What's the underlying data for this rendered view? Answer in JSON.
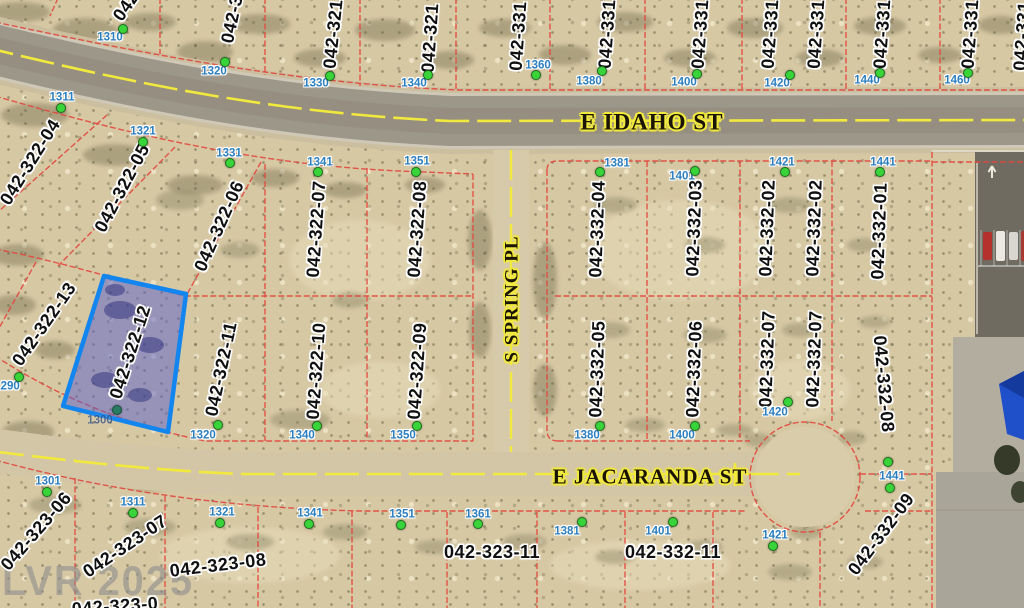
{
  "map": {
    "watermark": "LVR 2025",
    "selected_parcel": {
      "id": "042-322-12"
    },
    "streets": [
      {
        "name": "E IDAHO ST",
        "x": 652,
        "y": 122,
        "rot": 0,
        "size": 23
      },
      {
        "name": "S SPRING PL",
        "x": 512,
        "y": 299,
        "rot": -90,
        "size": 19
      },
      {
        "name": "E JACARANDA ST",
        "x": 650,
        "y": 477,
        "rot": 0,
        "size": 21
      }
    ],
    "parcel_labels": [
      {
        "id": "042",
        "x": 126,
        "y": 6,
        "rot": -55
      },
      {
        "id": "042-32",
        "x": 233,
        "y": 14,
        "rot": -78
      },
      {
        "id": "042-321",
        "x": 333,
        "y": 34,
        "rot": -84
      },
      {
        "id": "042-321",
        "x": 430,
        "y": 38,
        "rot": -86
      },
      {
        "id": "042-331",
        "x": 518,
        "y": 36,
        "rot": -86
      },
      {
        "id": "042-331",
        "x": 607,
        "y": 34,
        "rot": -86
      },
      {
        "id": "042-331",
        "x": 700,
        "y": 34,
        "rot": -86
      },
      {
        "id": "042-331",
        "x": 770,
        "y": 34,
        "rot": -86
      },
      {
        "id": "042-331",
        "x": 816,
        "y": 34,
        "rot": -86
      },
      {
        "id": "042-331",
        "x": 882,
        "y": 34,
        "rot": -86
      },
      {
        "id": "042-331",
        "x": 970,
        "y": 34,
        "rot": -86
      },
      {
        "id": "042-331",
        "x": 1022,
        "y": 36,
        "rot": -86
      },
      {
        "id": "042-322-04",
        "x": 30,
        "y": 162,
        "rot": -58
      },
      {
        "id": "042-322-05",
        "x": 122,
        "y": 188,
        "rot": -62
      },
      {
        "id": "042-322-06",
        "x": 219,
        "y": 226,
        "rot": -66
      },
      {
        "id": "042-322-07",
        "x": 316,
        "y": 229,
        "rot": -86
      },
      {
        "id": "042-322-08",
        "x": 417,
        "y": 229,
        "rot": -86
      },
      {
        "id": "042-322-13",
        "x": 44,
        "y": 324,
        "rot": -55
      },
      {
        "id": "042-322-12",
        "x": 130,
        "y": 352,
        "rot": -72,
        "sel": true
      },
      {
        "id": "042-322-11",
        "x": 221,
        "y": 369,
        "rot": -78
      },
      {
        "id": "042-322-10",
        "x": 316,
        "y": 371,
        "rot": -86
      },
      {
        "id": "042-322-09",
        "x": 417,
        "y": 371,
        "rot": -86
      },
      {
        "id": "042-332-04",
        "x": 597,
        "y": 229,
        "rot": -88
      },
      {
        "id": "042-332-03",
        "x": 694,
        "y": 228,
        "rot": -88
      },
      {
        "id": "042-332-02",
        "x": 767,
        "y": 228,
        "rot": -88
      },
      {
        "id": "042-332-02",
        "x": 814,
        "y": 228,
        "rot": -88
      },
      {
        "id": "042-332-01",
        "x": 879,
        "y": 231,
        "rot": -88
      },
      {
        "id": "042-332-05",
        "x": 597,
        "y": 369,
        "rot": -88
      },
      {
        "id": "042-332-06",
        "x": 694,
        "y": 369,
        "rot": -88
      },
      {
        "id": "042-332-07",
        "x": 767,
        "y": 359,
        "rot": -88
      },
      {
        "id": "042-332-07",
        "x": 814,
        "y": 359,
        "rot": -88
      },
      {
        "id": "042-332-08",
        "x": 884,
        "y": 384,
        "rot": 85
      },
      {
        "id": "042-332-09",
        "x": 881,
        "y": 534,
        "rot": -53
      },
      {
        "id": "042-323-06",
        "x": 36,
        "y": 531,
        "rot": -49
      },
      {
        "id": "042-323-07",
        "x": 125,
        "y": 546,
        "rot": -34
      },
      {
        "id": "042-323-08",
        "x": 218,
        "y": 565,
        "rot": -7
      },
      {
        "id": "042-323-11",
        "x": 492,
        "y": 552,
        "rot": 0
      },
      {
        "id": "042-332-11",
        "x": 673,
        "y": 552,
        "rot": 0
      },
      {
        "id": "042-323-0",
        "x": 115,
        "y": 606,
        "rot": -4
      }
    ],
    "address_labels": [
      {
        "num": "1310",
        "lx": 110,
        "ly": 38,
        "dots": [
          [
            123,
            29
          ]
        ]
      },
      {
        "num": "1320",
        "lx": 214,
        "ly": 72,
        "dots": [
          [
            225,
            62
          ]
        ]
      },
      {
        "num": "1330",
        "lx": 316,
        "ly": 84,
        "dots": [
          [
            330,
            76
          ]
        ]
      },
      {
        "num": "1340",
        "lx": 414,
        "ly": 84,
        "dots": [
          [
            428,
            75
          ]
        ]
      },
      {
        "num": "1360",
        "lx": 538,
        "ly": 66,
        "dots": [
          [
            536,
            75
          ]
        ]
      },
      {
        "num": "1380",
        "lx": 589,
        "ly": 82,
        "dots": [
          [
            602,
            71
          ]
        ]
      },
      {
        "num": "1400",
        "lx": 684,
        "ly": 83,
        "dots": [
          [
            697,
            74
          ]
        ]
      },
      {
        "num": "1420",
        "lx": 777,
        "ly": 84,
        "dots": [
          [
            790,
            75
          ]
        ]
      },
      {
        "num": "1440",
        "lx": 867,
        "ly": 81,
        "dots": [
          [
            880,
            73
          ]
        ]
      },
      {
        "num": "1460",
        "lx": 957,
        "ly": 81,
        "dots": [
          [
            968,
            73
          ]
        ]
      },
      {
        "num": "1311",
        "lx": 62,
        "ly": 98,
        "dots": [
          [
            61,
            108
          ]
        ]
      },
      {
        "num": "1321",
        "lx": 143,
        "ly": 132,
        "dots": [
          [
            143,
            142
          ]
        ]
      },
      {
        "num": "1331",
        "lx": 229,
        "ly": 154,
        "dots": [
          [
            230,
            163
          ]
        ]
      },
      {
        "num": "1341",
        "lx": 320,
        "ly": 163,
        "dots": [
          [
            318,
            172
          ]
        ]
      },
      {
        "num": "1351",
        "lx": 417,
        "ly": 162,
        "dots": [
          [
            416,
            172
          ]
        ]
      },
      {
        "num": "1381",
        "lx": 617,
        "ly": 164,
        "dots": [
          [
            600,
            172
          ]
        ]
      },
      {
        "num": "1401",
        "lx": 682,
        "ly": 177,
        "dots": [
          [
            695,
            171
          ]
        ]
      },
      {
        "num": "1421",
        "lx": 782,
        "ly": 163,
        "dots": [
          [
            785,
            172
          ]
        ]
      },
      {
        "num": "1441",
        "lx": 883,
        "ly": 163,
        "dots": [
          [
            880,
            172
          ]
        ]
      },
      {
        "num": "1290",
        "lx": 7,
        "ly": 387,
        "dots": [
          [
            19,
            377
          ]
        ]
      },
      {
        "num": "1300",
        "lx": 100,
        "ly": 421,
        "dark": true,
        "dots": [
          [
            117,
            410
          ]
        ]
      },
      {
        "num": "1320",
        "lx": 203,
        "ly": 436,
        "dots": [
          [
            218,
            425
          ]
        ]
      },
      {
        "num": "1340",
        "lx": 302,
        "ly": 436,
        "dots": [
          [
            317,
            426
          ]
        ]
      },
      {
        "num": "1350",
        "lx": 403,
        "ly": 436,
        "dots": [
          [
            417,
            426
          ]
        ]
      },
      {
        "num": "1380",
        "lx": 587,
        "ly": 436,
        "dots": [
          [
            600,
            426
          ]
        ]
      },
      {
        "num": "1400",
        "lx": 682,
        "ly": 436,
        "dots": [
          [
            695,
            426
          ]
        ]
      },
      {
        "num": "1420",
        "lx": 775,
        "ly": 413,
        "dots": [
          [
            788,
            402
          ]
        ]
      },
      {
        "num": "1441",
        "lx": 892,
        "ly": 477,
        "dots": [
          [
            888,
            462
          ],
          [
            890,
            488
          ]
        ]
      },
      {
        "num": "1301",
        "lx": 48,
        "ly": 482,
        "dots": [
          [
            47,
            492
          ]
        ]
      },
      {
        "num": "1311",
        "lx": 133,
        "ly": 503,
        "dots": [
          [
            133,
            513
          ]
        ]
      },
      {
        "num": "1321",
        "lx": 222,
        "ly": 513,
        "dots": [
          [
            220,
            523
          ]
        ]
      },
      {
        "num": "1341",
        "lx": 310,
        "ly": 514,
        "dots": [
          [
            309,
            524
          ]
        ]
      },
      {
        "num": "1351",
        "lx": 402,
        "ly": 515,
        "dots": [
          [
            401,
            525
          ]
        ]
      },
      {
        "num": "1361",
        "lx": 478,
        "ly": 515,
        "dots": [
          [
            478,
            524
          ]
        ]
      },
      {
        "num": "1381",
        "lx": 567,
        "ly": 532,
        "dots": [
          [
            582,
            522
          ]
        ]
      },
      {
        "num": "1401",
        "lx": 658,
        "ly": 532,
        "dots": [
          [
            673,
            522
          ]
        ]
      },
      {
        "num": "1421",
        "lx": 775,
        "ly": 536,
        "dots": [
          [
            773,
            546
          ]
        ]
      }
    ],
    "colors": {
      "parcel_line": "#e2493f",
      "highlight_fill": "rgba(88,94,203,0.5)",
      "highlight_outline": "#1285ef",
      "centerline_yellow": "#f2e93e",
      "address_text": "#2b7fc0",
      "parcel_text": "#101010",
      "street_halo": "#f2e93e",
      "dot_fill": "#39d439",
      "dot_border": "#1d6e1d",
      "watermark_gray": "#8f8f8f"
    }
  }
}
